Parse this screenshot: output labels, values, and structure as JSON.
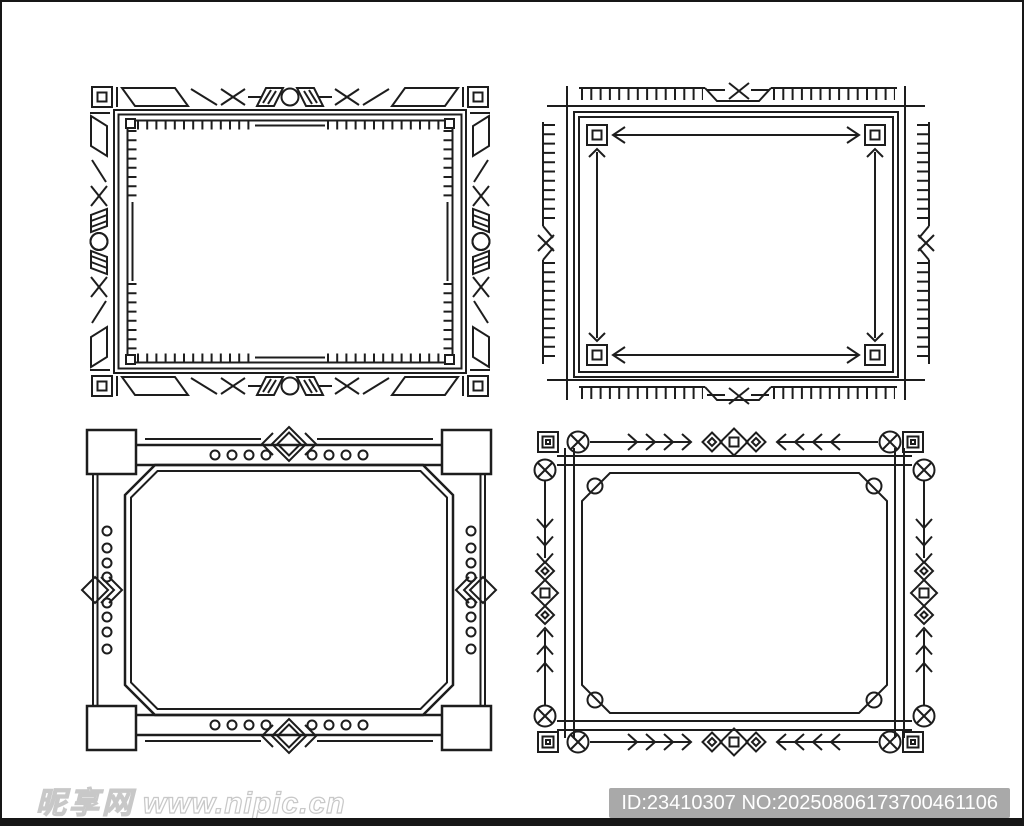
{
  "page": {
    "description": "Four black-and-white decorative vector border frames on a white background"
  },
  "frames": [
    {
      "label": "art-deco geometric frame with corner squares, X and circle ornaments, inner tick border",
      "position": "top-left"
    },
    {
      "label": "ruler-tick frame with X notches, nested corner squares and double-headed arrows",
      "position": "top-right"
    },
    {
      "label": "frame with solid corner blocks, dotted bars, side diamonds and chamfered inner panel",
      "position": "bottom-left"
    },
    {
      "label": "tribal arrow frame with circled-X marks, chevrons, dotted diamonds and chamfered inner panel",
      "position": "bottom-right"
    }
  ],
  "watermark": {
    "site_name": "昵享网",
    "site_url": "www.nipic.cn"
  },
  "id_bar": {
    "text": "ID:23410307 NO:20250806173700461106"
  },
  "colors": {
    "line": "#1d1d1d",
    "page_bg": "#ffffff",
    "border": "#171717",
    "badge_bg": "#a9a9a9",
    "badge_text": "#ffffff",
    "watermark_stroke": "#c8c8c8"
  }
}
